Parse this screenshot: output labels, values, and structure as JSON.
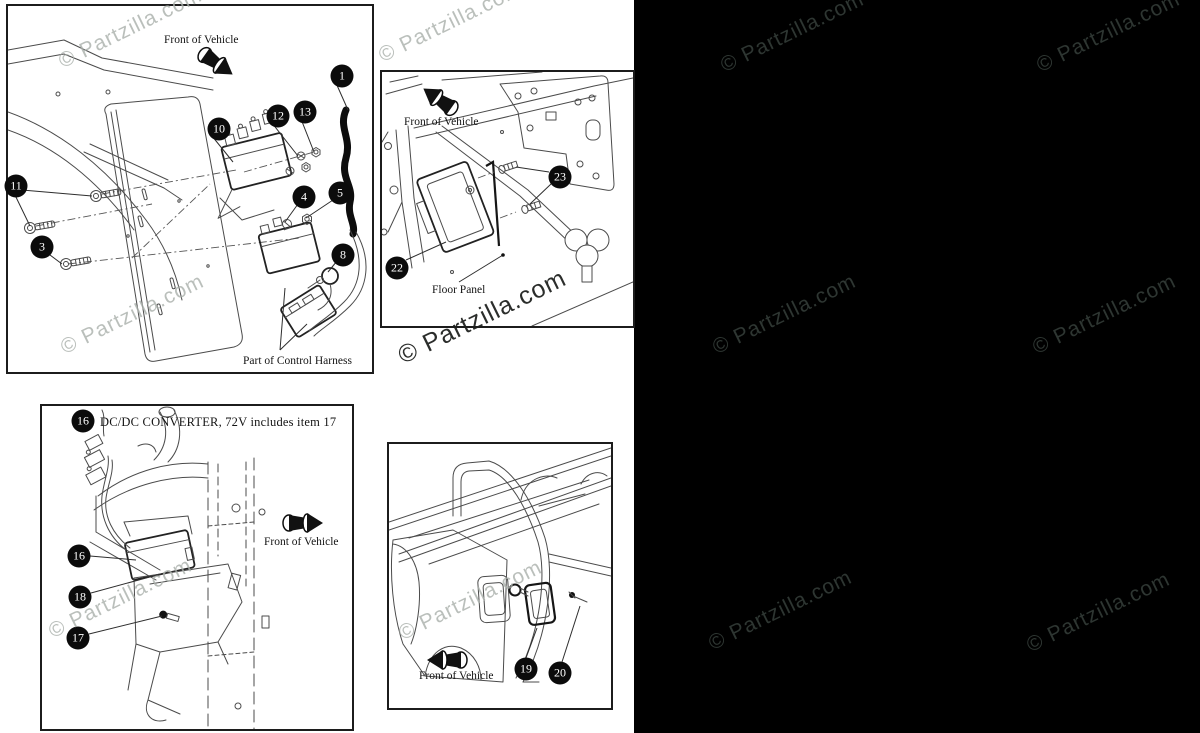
{
  "watermark": {
    "text": "© Partzilla.com"
  },
  "callouts": {
    "c1": "1",
    "c3": "3",
    "c4": "4",
    "c5": "5",
    "c8": "8",
    "c10": "10",
    "c11": "11",
    "c12": "12",
    "c13": "13",
    "c16": "16",
    "c17": "17",
    "c18": "18",
    "c19": "19",
    "c20": "20",
    "c22": "22",
    "c23": "23"
  },
  "labels": {
    "front_of_vehicle": "Front of Vehicle",
    "part_of_control_harness": "Part of Control Harness",
    "floor_panel": "Floor Panel",
    "dcdc_header": "DC/DC CONVERTER, 72V includes item 17"
  },
  "colors": {
    "line": "#4b4b4b",
    "callout_bg": "#0b0b0b",
    "watermark_light": "#aab0ab",
    "watermark_strong": "#1e201e",
    "watermark_on_black": "#2e3632",
    "black_region": "#000000"
  }
}
